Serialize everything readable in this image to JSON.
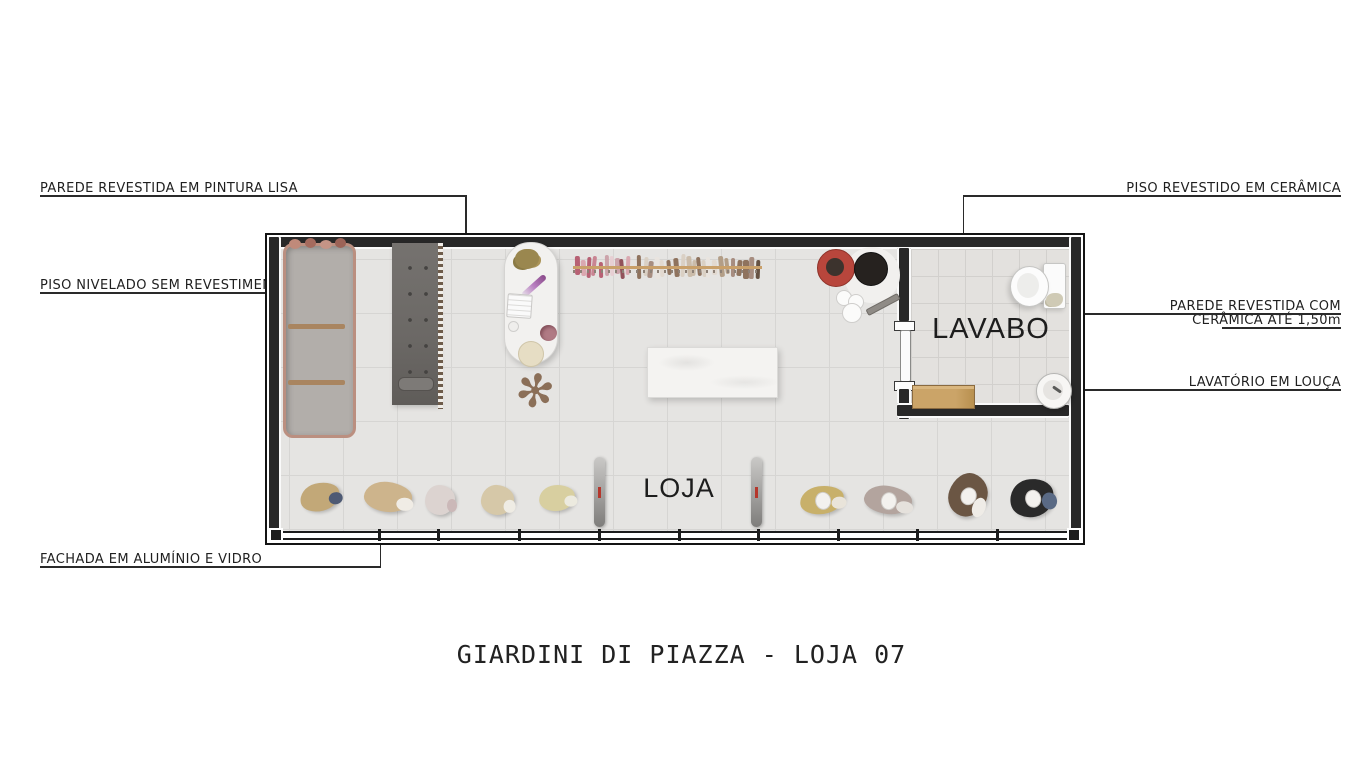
{
  "title": "GIARDINI DI PIAZZA - LOJA 07",
  "rooms": {
    "loja": "LOJA",
    "lavabo": "LAVABO"
  },
  "annotations": {
    "parede_pintura": "PAREDE REVESTIDA EM PINTURA LISA",
    "piso_nivelado": "PISO NIVELADO SEM REVESTIMENTO",
    "fachada": "FACHADA EM ALUMÍNIO E VIDRO",
    "piso_ceramica": "PISO REVESTIDO EM CERÂMICA",
    "parede_ceramica_l1": "PAREDE REVESTIDA COM",
    "parede_ceramica_l2": "CERÂMICA ATÉ 1,50m",
    "lavatorio": "LAVATÓRIO EM LOUÇA"
  },
  "colors": {
    "wall": "#282828",
    "leader_line": "#2a2a2a",
    "floor_tile": "#e5e4e2",
    "copper_frame": "#bb8f80",
    "wood": "#c49a62",
    "accent_red": "#b5372c"
  },
  "icons": [
    "toilet-icon",
    "sink-icon",
    "door-icon",
    "clothes-rack-icon",
    "mannequin-icon",
    "mirror-icon",
    "plant-icon",
    "counter-icon"
  ],
  "rack": {
    "railY": 31,
    "clusters": [
      {
        "x0": 308,
        "x1": 360,
        "colors": [
          "#c77f8e",
          "#b45a6e",
          "#d9a4ad",
          "#8d4a52",
          "#e7cdd2",
          "#caa0a8"
        ]
      },
      {
        "x0": 370,
        "x1": 494,
        "colors": [
          "#e9e4de",
          "#d9cfc2",
          "#b09a82",
          "#8a6d56",
          "#5f4a3a",
          "#e2d8cf",
          "#c9b9a6",
          "#a3887a"
        ]
      }
    ]
  },
  "figures": [
    {
      "x": 53,
      "y": 262,
      "w": 40,
      "h": 28,
      "rot": -14,
      "color": "#c2a878",
      "accent": "#4e5a74",
      "head": false
    },
    {
      "x": 121,
      "y": 262,
      "w": 48,
      "h": 30,
      "rot": 6,
      "color": "#cdb48c",
      "accent": "#f0ece5",
      "head": false
    },
    {
      "x": 173,
      "y": 265,
      "w": 30,
      "h": 30,
      "rot": 0,
      "color": "#dcd3d0",
      "accent": "#cbb8b8",
      "head": false
    },
    {
      "x": 230,
      "y": 265,
      "w": 33,
      "h": 30,
      "rot": 4,
      "color": "#d6c8a8",
      "accent": "#efece4",
      "head": false
    },
    {
      "x": 290,
      "y": 263,
      "w": 36,
      "h": 26,
      "rot": -6,
      "color": "#d8cfa0",
      "accent": "#eceadf",
      "head": false
    },
    {
      "x": 555,
      "y": 265,
      "w": 44,
      "h": 28,
      "rot": -8,
      "color": "#c8b06a",
      "accent": "#e9e4da",
      "head": true
    },
    {
      "x": 621,
      "y": 265,
      "w": 48,
      "h": 28,
      "rot": 8,
      "color": "#b3a49e",
      "accent": "#e5e1dc",
      "head": true
    },
    {
      "x": 701,
      "y": 260,
      "w": 38,
      "h": 44,
      "rot": 20,
      "color": "#6b5644",
      "accent": "#efece7",
      "head": true
    },
    {
      "x": 765,
      "y": 263,
      "w": 44,
      "h": 38,
      "rot": -12,
      "color": "#2a2a2a",
      "accent": "#5a6a85",
      "head": true
    }
  ],
  "circles": [
    {
      "cx": 605,
      "cy": 40,
      "r": 28,
      "fill": "#f1f0ee",
      "stroke": "none"
    },
    {
      "cx": 568,
      "cy": 32,
      "r": 18,
      "fill": "#b8463c",
      "stroke": "#8e3229"
    },
    {
      "cx": 568,
      "cy": 32,
      "r": 9,
      "fill": "#3c332d",
      "stroke": "none"
    },
    {
      "cx": 603,
      "cy": 33,
      "r": 16,
      "fill": "#26221f",
      "stroke": "#111"
    },
    {
      "cx": 576,
      "cy": 62,
      "r": 7,
      "fill": "#fbfbfa",
      "stroke": "#cfcecc"
    },
    {
      "cx": 588,
      "cy": 66,
      "r": 7,
      "fill": "#fbfbfa",
      "stroke": "#cfcecc"
    },
    {
      "cx": 584,
      "cy": 77,
      "r": 9,
      "fill": "#fbfbfa",
      "stroke": "#cfcecc"
    }
  ],
  "mullions": [
    111,
    170,
    251,
    331,
    411,
    490,
    570,
    649,
    729
  ]
}
